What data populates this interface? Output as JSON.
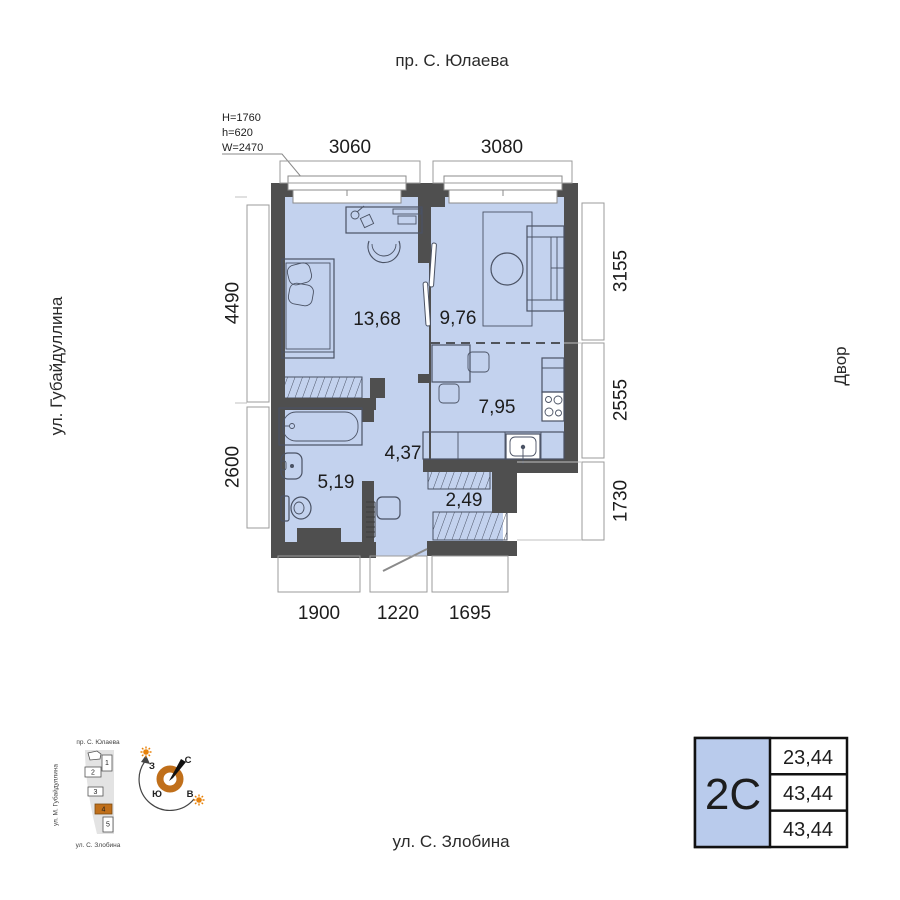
{
  "streets": {
    "top": "пр. С. Юлаева",
    "left": "ул. Губайдуллина",
    "right": "Двор",
    "bottom": "ул. С. Злобина"
  },
  "window_annotation": {
    "line1": "H=1760",
    "line2": "h=620",
    "line3": "W=2470"
  },
  "dims": {
    "top": [
      "3060",
      "3080"
    ],
    "left": [
      "4490",
      "2600"
    ],
    "right": [
      "3155",
      "2555",
      "1730"
    ],
    "bottom": [
      "1900",
      "1220",
      "1695"
    ]
  },
  "areas": {
    "bedroom": "13,68",
    "living": "9,76",
    "kitchen": "7,95",
    "hallway": "4,37",
    "bathroom": "5,19",
    "closet": "2,49"
  },
  "info_box": {
    "unit_type": "2С",
    "rows": [
      "23,44",
      "43,44",
      "43,44"
    ]
  },
  "site_plan": {
    "street_top": "пр. С. Юлаева",
    "street_left": "ул. М. Губайдуллина",
    "street_bottom": "ул. С. Злобина",
    "buildings": [
      "1",
      "2",
      "3",
      "4",
      "5"
    ],
    "highlighted_building": "4"
  },
  "compass": {
    "north": "С",
    "south": "Ю",
    "west": "З",
    "east": "В"
  },
  "colors": {
    "floor_fill": "#c3d2ee",
    "wall": "#4f4f4f",
    "accent_orange": "#c06f1a",
    "sun_orange": "#e8820a",
    "info_cell_fill": "#b9cbec",
    "dim_line": "#9b9b9b",
    "text": "#1d1d1d"
  }
}
